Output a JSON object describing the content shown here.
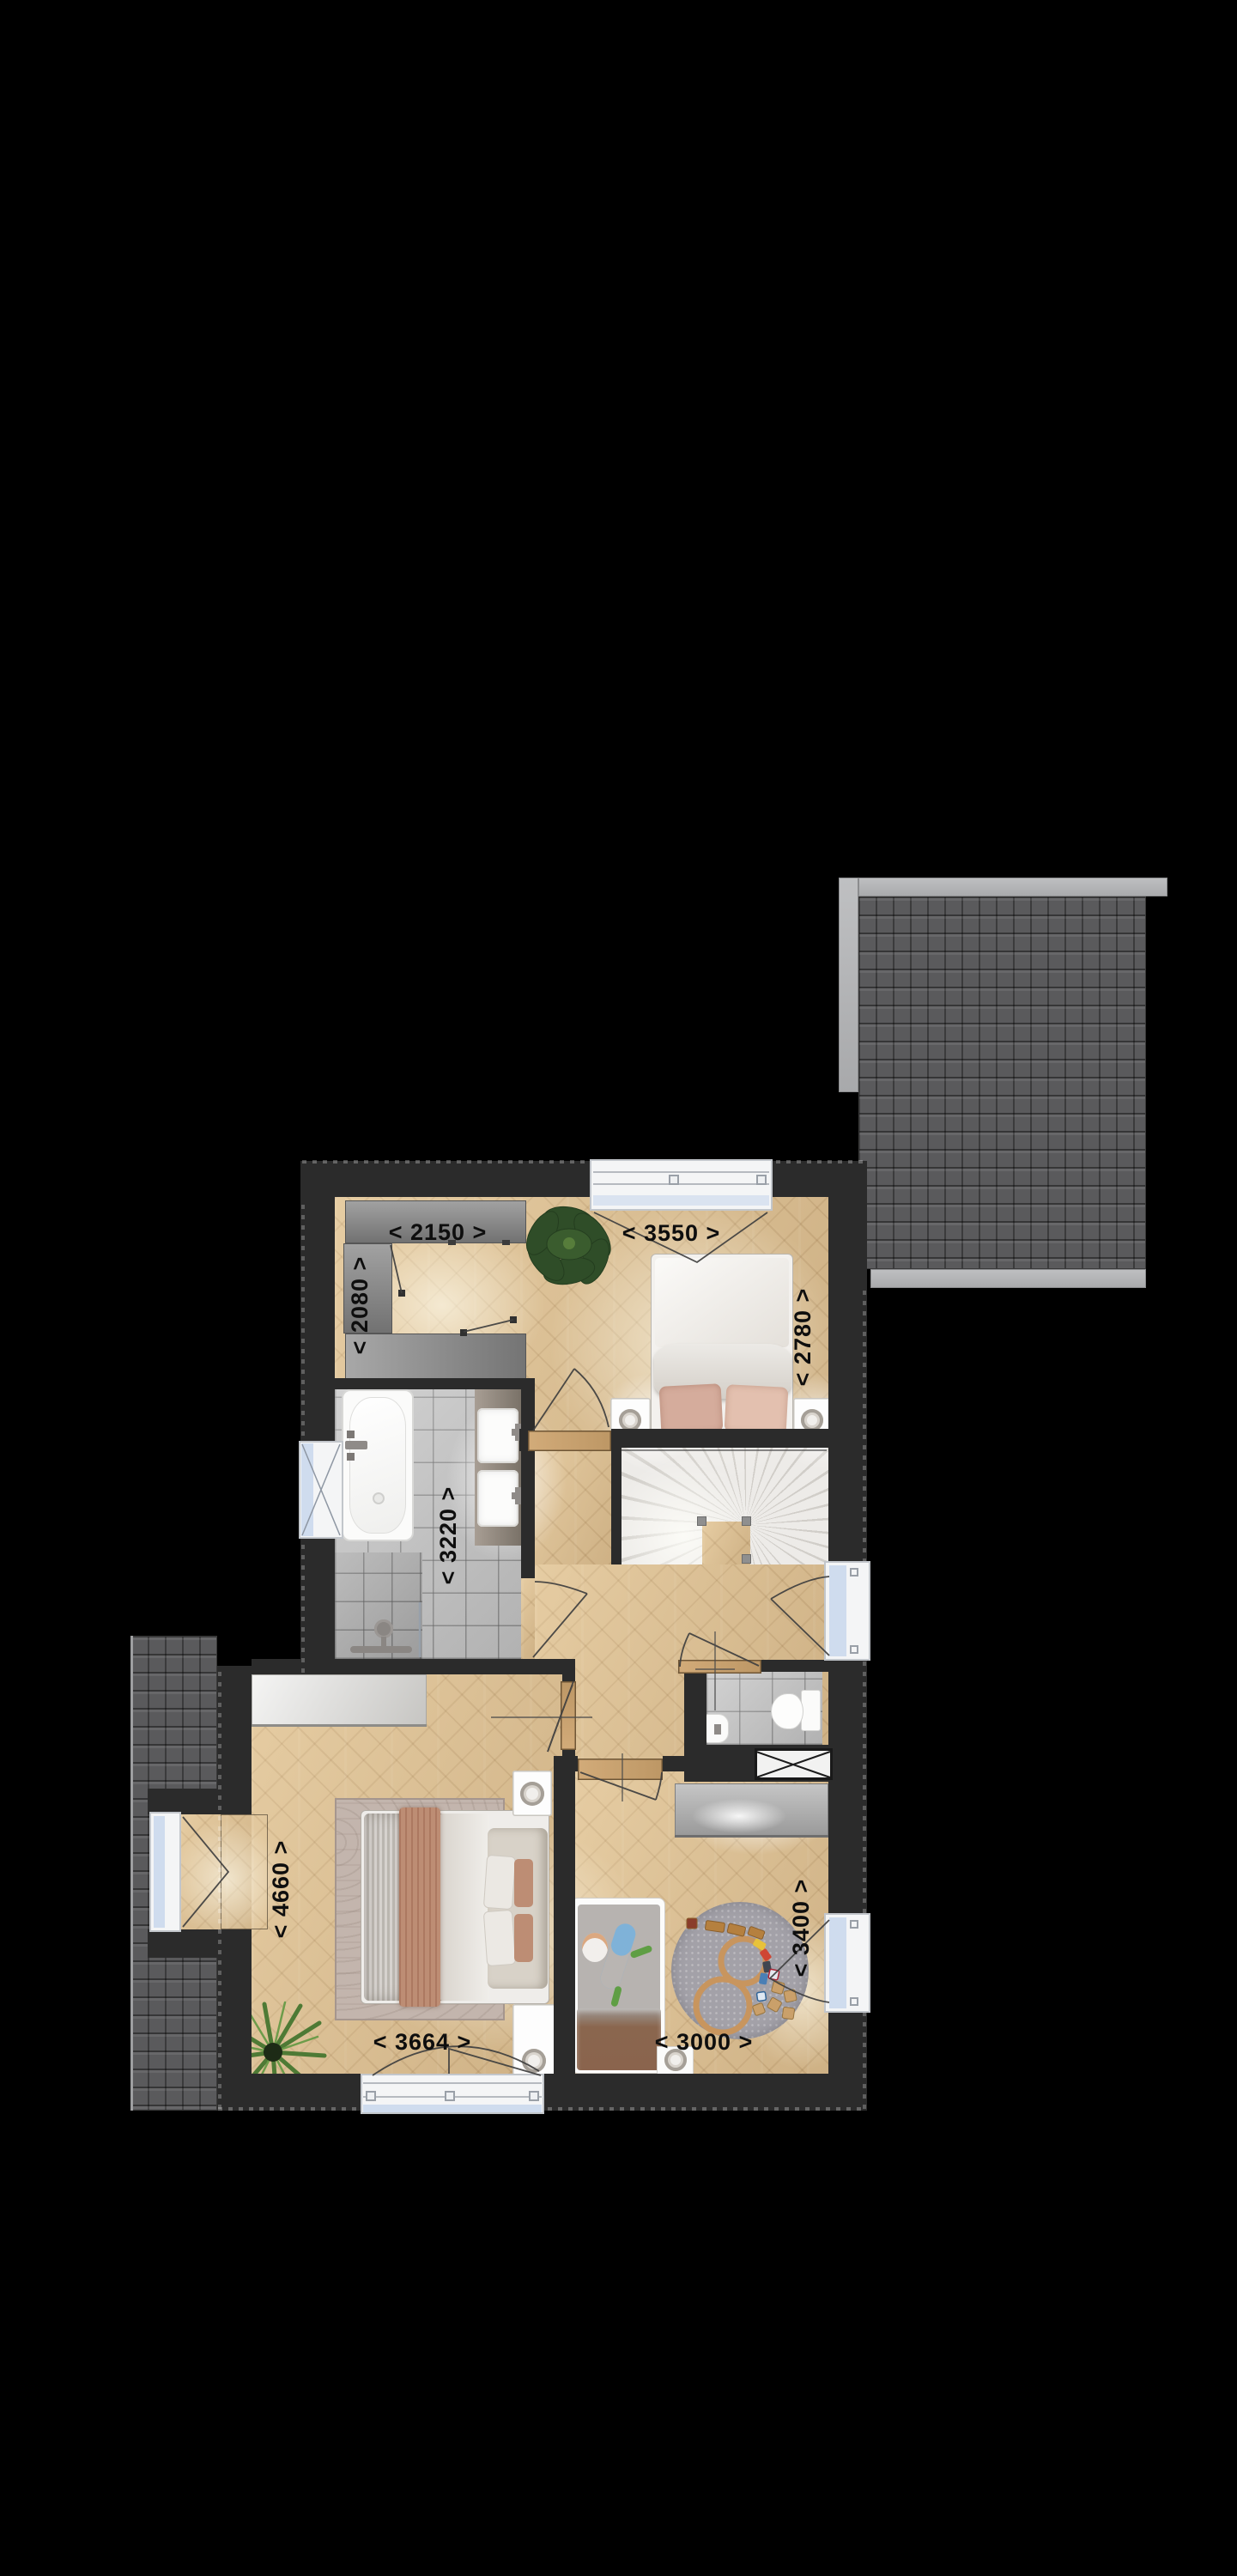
{
  "floorplan": {
    "dimension_labels": [
      {
        "id": "closet-width",
        "text": "< 2150 >",
        "orientation": "horizontal"
      },
      {
        "id": "bedroom-top-width",
        "text": "< 3550 >",
        "orientation": "horizontal"
      },
      {
        "id": "closet-depth",
        "text": "< 2080 >",
        "orientation": "vertical"
      },
      {
        "id": "bedroom-top-depth",
        "text": "< 2780 >",
        "orientation": "vertical"
      },
      {
        "id": "bathroom-depth",
        "text": "< 3220 >",
        "orientation": "vertical"
      },
      {
        "id": "bedroom-left-depth",
        "text": "< 4660 >",
        "orientation": "vertical"
      },
      {
        "id": "bedroom-left-width",
        "text": "< 3664 >",
        "orientation": "horizontal"
      },
      {
        "id": "bedroom-right-width",
        "text": "< 3000 >",
        "orientation": "horizontal"
      },
      {
        "id": "bedroom-right-depth",
        "text": "< 3400 >",
        "orientation": "vertical"
      }
    ],
    "colors": {
      "background": "#000000",
      "wall": "#2b2b2b",
      "roof_tile": "#5a5a5c",
      "roof_ridge": "#b4b5b7",
      "wood_floor": "#dcc094",
      "tile_floor": "#bfbfbf",
      "glass": "#cfdcee",
      "label_text": "#0e0e0e"
    }
  }
}
